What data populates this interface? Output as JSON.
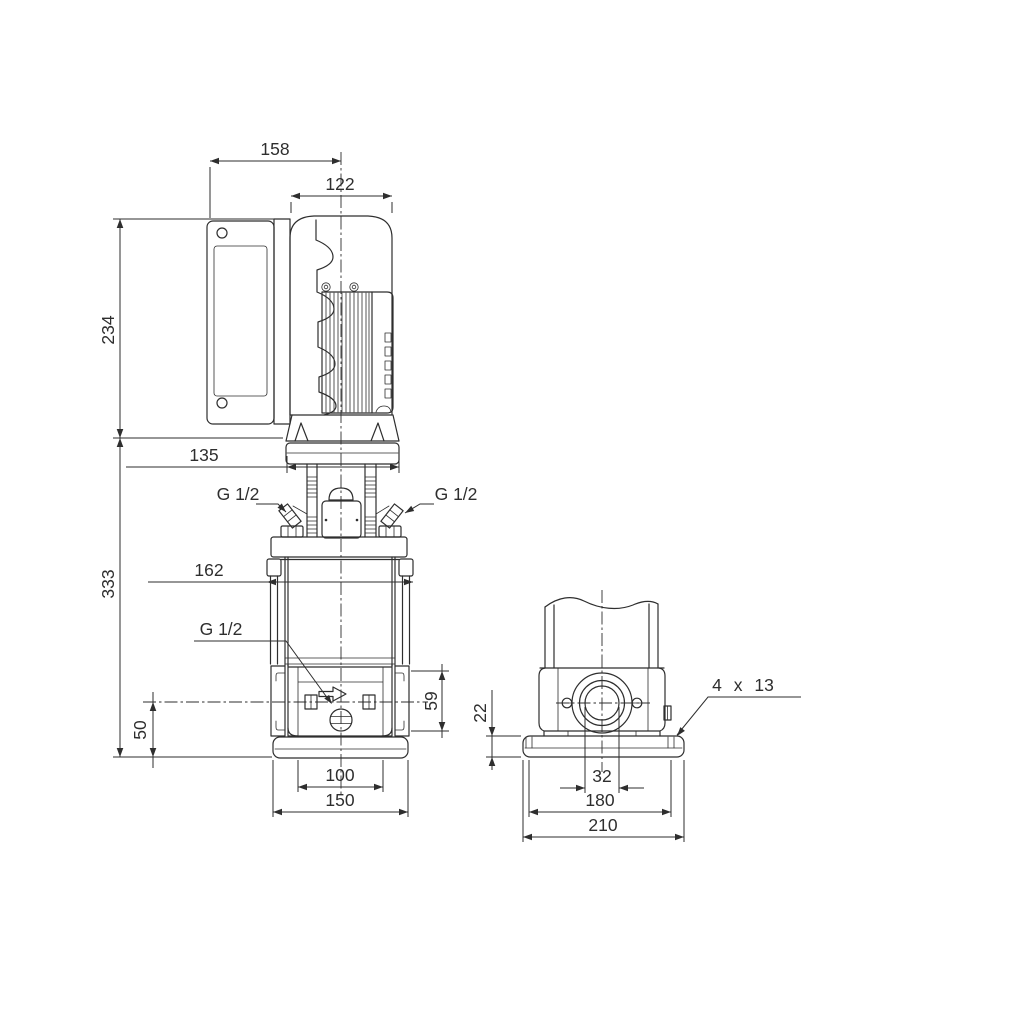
{
  "colors": {
    "line": "#2e2e2e",
    "bg": "#ffffff"
  },
  "front_view": {
    "dims": {
      "overall_width": "158",
      "motor_width": "122",
      "motor_height": "234",
      "head_width": "135",
      "pump_height": "333",
      "port_center_height": "50",
      "sleeve_width": "162",
      "port_flange_height": "59",
      "base_hole_spacing": "100",
      "base_width": "150"
    },
    "labels": {
      "port_left": "G 1/2",
      "port_right": "G 1/2",
      "drain_port": "G 1/2"
    }
  },
  "side_view": {
    "dims": {
      "baseplate_height": "22",
      "port_bore": "32",
      "bolt_hole_spacing": "180",
      "baseplate_length": "210"
    },
    "labels": {
      "bolt_holes": "4 x 13"
    }
  }
}
